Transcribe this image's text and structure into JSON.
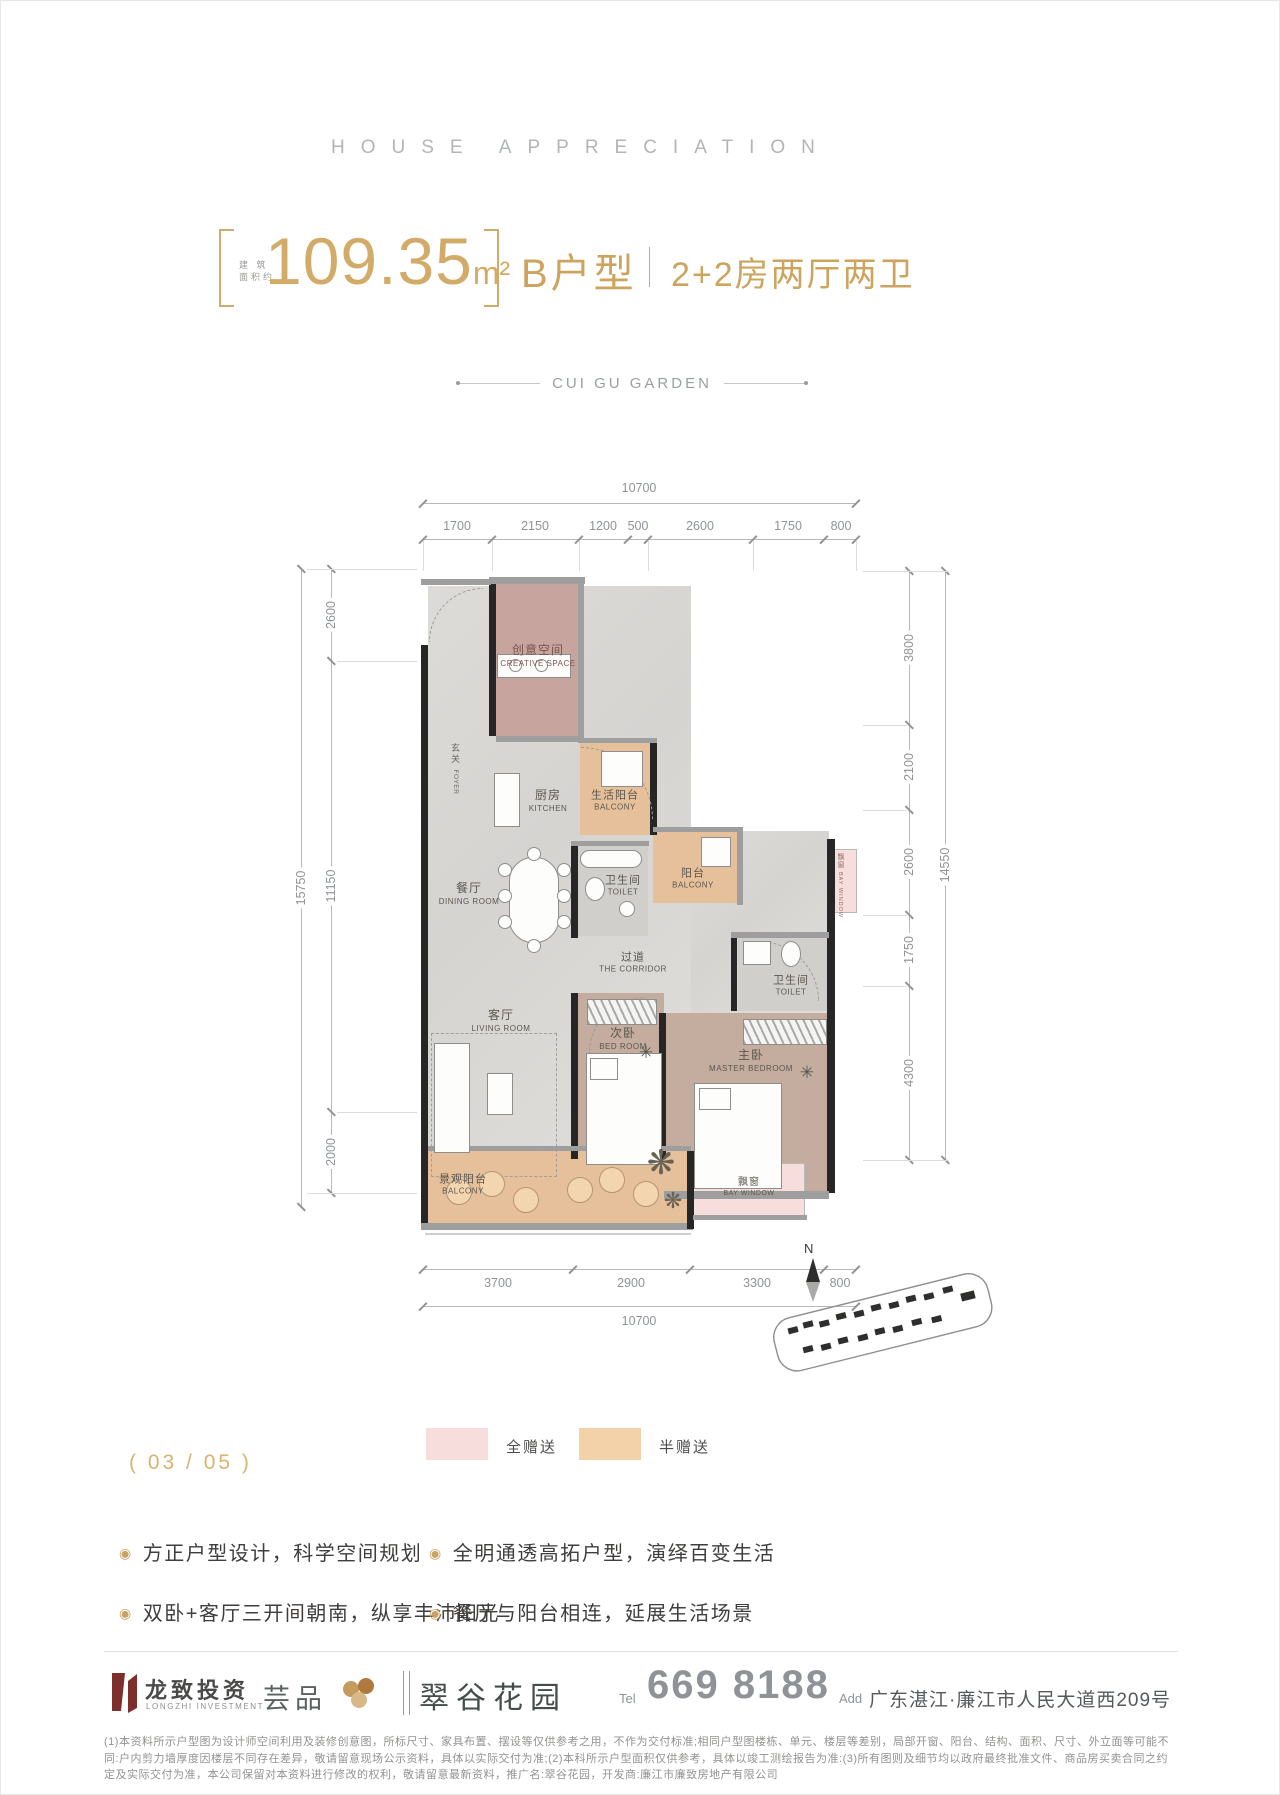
{
  "colors": {
    "accent_gold": "#d3ab68",
    "full_gift_pink": "#f8dddd",
    "half_gift_tan": "#f3d2a9",
    "logo_red": "#7e2f2c",
    "wall_dark": "#262626"
  },
  "header": {
    "title_en": "HOUSE APPRECIATION",
    "area_prefix_line1": "建 筑",
    "area_prefix_line2": "面积约",
    "area_value": "109.35",
    "area_unit": "m²",
    "unit_type": "B户型",
    "unit_desc": "2+2房两厅两卫",
    "garden_en": "CUI GU GARDEN"
  },
  "plan": {
    "dims": {
      "top_total": "10700",
      "top_segments": [
        "1700",
        "2150",
        "1200",
        "500",
        "2600",
        "1750",
        "800"
      ],
      "bottom_segments": [
        "3700",
        "2900",
        "3300",
        "800"
      ],
      "bottom_total": "10700",
      "left_outer": "15750",
      "left_segments": [
        "2600",
        "11150",
        "2000"
      ],
      "right_outer": "14550",
      "right_segments": [
        "3800",
        "2100",
        "2600",
        "1750",
        "4300"
      ]
    },
    "rooms": {
      "creative": {
        "zh": "创意空间",
        "en": "CREATIVE SPACE"
      },
      "foyer": {
        "zh": "玄关",
        "en": "FOYER"
      },
      "kitchen": {
        "zh": "厨房",
        "en": "KITCHEN"
      },
      "life_balcony": {
        "zh": "生活阳台",
        "en": "BALCONY"
      },
      "toilet_1": {
        "zh": "卫生间",
        "en": "TOILET"
      },
      "dining": {
        "zh": "餐厅",
        "en": "DINING ROOM"
      },
      "balcony_mid": {
        "zh": "阳台",
        "en": "BALCONY"
      },
      "corridor": {
        "zh": "过道",
        "en": "THE CORRIDOR"
      },
      "toilet_2": {
        "zh": "卫生间",
        "en": "TOILET"
      },
      "living": {
        "zh": "客厅",
        "en": "LIVING ROOM"
      },
      "bedroom_2": {
        "zh": "次卧",
        "en": "BED ROOM"
      },
      "master": {
        "zh": "主卧",
        "en": "MASTER BEDROOM"
      },
      "view_balcony": {
        "zh": "景观阳台",
        "en": "BALCONY"
      },
      "bay_window": {
        "zh": "飘窗",
        "en": "BAY WINDOW"
      },
      "bay_window_right": {
        "zh": "飘窗",
        "en": "BAY WINDOW"
      }
    },
    "compass_label": "N"
  },
  "legend": {
    "full_gift": {
      "label": "全赠送",
      "color": "#f8dddd"
    },
    "half_gift": {
      "label": "半赠送",
      "color": "#f3d2a9"
    }
  },
  "page_indicator": "( 03 / 05 )",
  "features": [
    "方正户型设计，科学空间规划",
    "双卧+客厅三开间朝南，纵享丰沛阳光",
    "全明通透高拓户型，演绎百变生活",
    "餐厅与阳台相连，延展生活场景"
  ],
  "footer": {
    "logo_zh": "龙致投资",
    "logo_en": "LONGZHI INVESTMENT",
    "brand2": "芸品",
    "brand3": "翠谷花园",
    "tel_label": "Tel",
    "tel_value": "669 8188",
    "add_label": "Add",
    "add_value": "广东湛江·廉江市人民大道西209号"
  },
  "disclaimer": "(1)本资料所示户型图为设计师空间利用及装修创意图，所标尺寸、家具布置、摆设等仅供参考之用，不作为交付标准;相同户型图楼栋、单元、楼层等差别，局部开窗、阳台、结构、面积、尺寸、外立面等可能不同:户内剪力墙厚度因楼层不同存在差异，敬请留意现场公示资料，具体以实际交付为准;(2)本科所示户型面积仅供参考，具体以竣工测绘报告为准:(3)所有图则及细节均以政府最终批准文件、商品房买卖合同之约定及实际交付为准，本公司保留对本资料进行修改的权利，敬请留意最新资料，推广名:翠谷花园，开发商:廉江市廉致房地产有限公司"
}
